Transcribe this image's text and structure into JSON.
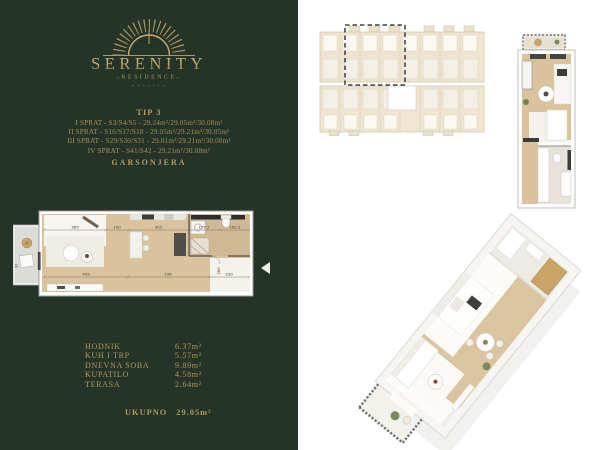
{
  "brand": {
    "name": "SERENITY",
    "subtitle": "-RESIDENCE-"
  },
  "info": {
    "type_label": "TIP 3",
    "lines": [
      "I SPRAT - S3/S4/S5 - 29.24m²/29.05m²/30.08m²",
      "II SPRAT - S16/S17/S18 - 29.05m²/29.21m²/30.05m²",
      "III SPRAT - S29/S30/S31 - 29.01m²/29.21m²/30.08m²",
      "IV SPRAT - S41/S42 - 29.21m²/30.08m²"
    ],
    "unit_type": "GARSONJERA"
  },
  "rooms": [
    {
      "label": "HODNIK",
      "area": "6.37m²"
    },
    {
      "label": "KUH I TRP",
      "area": "5.57m²"
    },
    {
      "label": "DNEVNA SOBA",
      "area": "9.89m²"
    },
    {
      "label": "KUPATILO",
      "area": "4.58m²"
    },
    {
      "label": "TERASA",
      "area": "2.64m²"
    }
  ],
  "total": {
    "label": "UKUPNO",
    "value": "29.05m²"
  },
  "floorplan_2d": {
    "dims": {
      "top": [
        "385",
        "100",
        "305",
        "177.5",
        "162.5"
      ],
      "middle": [
        "455",
        "196",
        "230"
      ],
      "vertical": [
        "360",
        "92"
      ]
    }
  },
  "colors": {
    "panel_green": "#253428",
    "gold": "#b1975c",
    "gold_bright": "#c9ae6c",
    "wood": "#d9c29c",
    "tile": "#cfb893",
    "door_wood": "#c9a467"
  }
}
